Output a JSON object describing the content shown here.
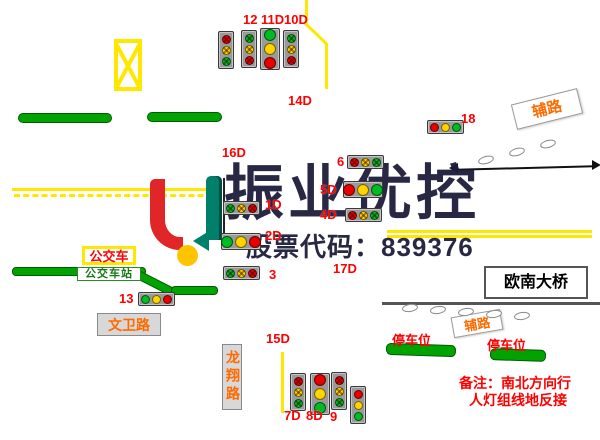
{
  "canvas": {
    "width": 600,
    "height": 440,
    "background": "#ffffff"
  },
  "watermark": {
    "company_name": "振业优控",
    "stock_code_line": "股票代码：839376",
    "text_color": "#1d1d3c"
  },
  "signs": {
    "fulu_top": "辅路",
    "fulu_bottom": "辅路",
    "ounan_bridge": "欧南大桥",
    "wenwei_road": "文卫路",
    "longxiang_road": "龙翔路",
    "bus": "公交车",
    "bus_station": "公交车站",
    "parking_left": "停车位",
    "parking_right": "停车位"
  },
  "note": {
    "line1": "备注：南北方向行",
    "line2": "人灯组线地反接"
  },
  "signal_labels": [
    {
      "text": "12",
      "x": 243,
      "y": 13
    },
    {
      "text": "11D",
      "x": 261,
      "y": 13
    },
    {
      "text": "10D",
      "x": 284,
      "y": 13
    },
    {
      "text": "14D",
      "x": 288,
      "y": 94
    },
    {
      "text": "16D",
      "x": 222,
      "y": 146
    },
    {
      "text": "1D",
      "x": 265,
      "y": 198
    },
    {
      "text": "2D",
      "x": 265,
      "y": 229
    },
    {
      "text": "3",
      "x": 269,
      "y": 268
    },
    {
      "text": "6",
      "x": 337,
      "y": 155
    },
    {
      "text": "5D",
      "x": 320,
      "y": 183
    },
    {
      "text": "4D",
      "x": 320,
      "y": 208
    },
    {
      "text": "17D",
      "x": 333,
      "y": 262
    },
    {
      "text": "18",
      "x": 461,
      "y": 112
    },
    {
      "text": "13",
      "x": 119,
      "y": 292
    },
    {
      "text": "15D",
      "x": 266,
      "y": 332
    },
    {
      "text": "7D",
      "x": 284,
      "y": 409
    },
    {
      "text": "8D",
      "x": 306,
      "y": 409
    },
    {
      "text": "9",
      "x": 330,
      "y": 410
    }
  ],
  "traffic_lights": [
    {
      "id": "north-a",
      "x": 218,
      "y": 31,
      "o": "v",
      "large": false,
      "arrow": true,
      "bulbs": [
        "red",
        "yellow",
        "green"
      ]
    },
    {
      "id": "north-12",
      "x": 241,
      "y": 30,
      "o": "v",
      "large": false,
      "arrow": true,
      "bulbs": [
        "green",
        "yellow",
        "red"
      ]
    },
    {
      "id": "north-11d",
      "x": 260,
      "y": 28,
      "o": "v",
      "large": true,
      "arrow": false,
      "bulbs": [
        "green",
        "yellow",
        "red"
      ]
    },
    {
      "id": "north-10d",
      "x": 283,
      "y": 30,
      "o": "v",
      "large": false,
      "arrow": true,
      "bulbs": [
        "green",
        "yellow",
        "red"
      ]
    },
    {
      "id": "1d",
      "x": 223,
      "y": 201,
      "o": "h",
      "large": false,
      "arrow": true,
      "bulbs": [
        "green",
        "yellow",
        "red"
      ]
    },
    {
      "id": "2d",
      "x": 221,
      "y": 233,
      "o": "h",
      "large": true,
      "arrow": false,
      "bulbs": [
        "green",
        "yellow",
        "red"
      ]
    },
    {
      "id": "3",
      "x": 223,
      "y": 266,
      "o": "h",
      "large": false,
      "arrow": true,
      "bulbs": [
        "green",
        "yellow",
        "red"
      ]
    },
    {
      "id": "6",
      "x": 347,
      "y": 155,
      "o": "h",
      "large": false,
      "arrow": true,
      "bulbs": [
        "red",
        "yellow",
        "green"
      ]
    },
    {
      "id": "5d",
      "x": 343,
      "y": 181,
      "o": "h",
      "large": true,
      "arrow": false,
      "bulbs": [
        "red",
        "yellow",
        "green"
      ]
    },
    {
      "id": "4d",
      "x": 345,
      "y": 208,
      "o": "h",
      "large": false,
      "arrow": true,
      "bulbs": [
        "red",
        "yellow",
        "green"
      ]
    },
    {
      "id": "18",
      "x": 427,
      "y": 120,
      "o": "h",
      "large": false,
      "arrow": false,
      "bulbs": [
        "red",
        "yellow",
        "green"
      ]
    },
    {
      "id": "13",
      "x": 138,
      "y": 292,
      "o": "h",
      "large": false,
      "arrow": false,
      "bulbs": [
        "green",
        "yellow",
        "red"
      ]
    },
    {
      "id": "7d",
      "x": 290,
      "y": 373,
      "o": "v",
      "large": false,
      "arrow": true,
      "bulbs": [
        "red",
        "yellow",
        "green"
      ]
    },
    {
      "id": "8d",
      "x": 310,
      "y": 373,
      "o": "v",
      "large": true,
      "arrow": false,
      "bulbs": [
        "red",
        "yellow",
        "green"
      ]
    },
    {
      "id": "9",
      "x": 331,
      "y": 372,
      "o": "v",
      "large": false,
      "arrow": true,
      "bulbs": [
        "red",
        "yellow",
        "green"
      ]
    },
    {
      "id": "aux-south",
      "x": 350,
      "y": 386,
      "o": "v",
      "large": false,
      "arrow": false,
      "bulbs": [
        "red",
        "yellow",
        "green"
      ]
    }
  ],
  "colors": {
    "signal_red": "#e80000",
    "signal_yellow": "#ffd400",
    "signal_green": "#00bb22",
    "road_green": "#00a300",
    "lane_yellow": "#ffe800",
    "label_red": "#ff0000",
    "sign_orange": "#ff6a00"
  }
}
